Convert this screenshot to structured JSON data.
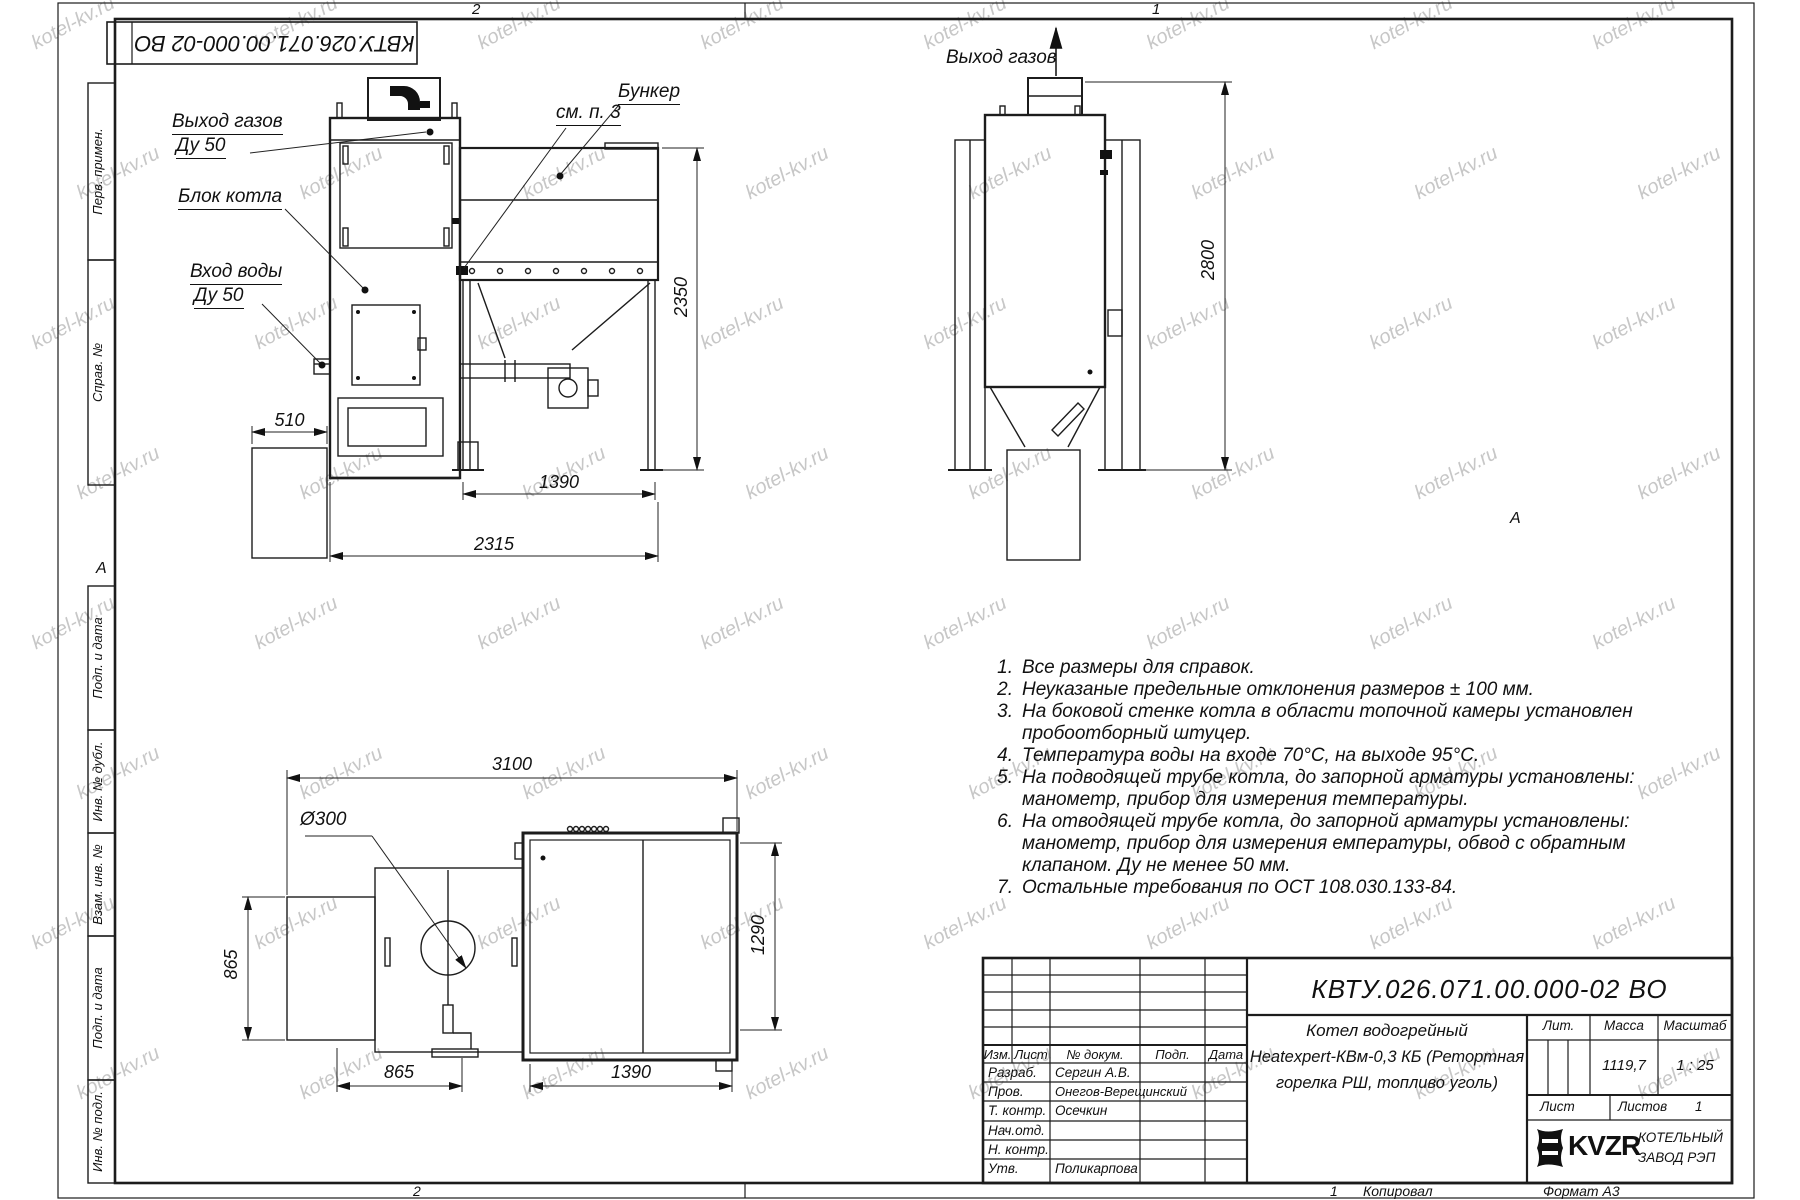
{
  "watermark": {
    "text": "kotel-kv.ru"
  },
  "frame": {
    "doc_number_top": "КВТУ.026.071.00.000-02 ВО",
    "zone_top_left": "2",
    "zone_top_right": "1",
    "zone_bottom_left": "2",
    "zone_bottom_right": "1",
    "copied_label": "Копировал",
    "format_label": "Формат А3",
    "zone_marker_left": "А",
    "zone_marker_right": "А",
    "stamps": [
      {
        "label": "Перв. примен."
      },
      {
        "label": "Справ. №"
      },
      {
        "label": "Подп. и дата"
      },
      {
        "label": "Инв. № дубл."
      },
      {
        "label": "Взам. инв. №"
      },
      {
        "label": "Подп. и дата"
      },
      {
        "label": "Инв. № подл."
      }
    ]
  },
  "views": {
    "front": {
      "labels": {
        "gas_out": "Выход газов",
        "gas_out_dn": "Ду 50",
        "boiler_block": "Блок котла",
        "water_in": "Вход воды",
        "water_in_dn": "Ду 50",
        "see_note": "см. п. 3",
        "bunker": "Бункер"
      },
      "dims": {
        "d510": "510",
        "d1390": "1390",
        "d2315": "2315",
        "d2350": "2350"
      }
    },
    "side": {
      "labels": {
        "gas_out": "Выход газов"
      },
      "dims": {
        "d2800": "2800"
      }
    },
    "plan": {
      "dims": {
        "d3100": "3100",
        "d300": "Ø300",
        "d865_left": "865",
        "d865_bottom": "865",
        "d1390": "1390",
        "d1290": "1290"
      }
    }
  },
  "notes": {
    "lines": [
      {
        "n": "1.",
        "t": "Все размеры для справок."
      },
      {
        "n": "2.",
        "t": "Неуказаные предельные отклонения размеров ± 100 мм."
      },
      {
        "n": "3.",
        "t": "На боковой стенке котла в области топочной камеры установлен"
      },
      {
        "n": "",
        "t": "пробоотборный штуцер."
      },
      {
        "n": "4.",
        "t": "Температура воды на входе 70°С, на выходе 95°С."
      },
      {
        "n": "5.",
        "t": "На подводящей трубе котла, до запорной арматуры установлены:"
      },
      {
        "n": "",
        "t": "манометр, прибор для измерения температуры."
      },
      {
        "n": "6.",
        "t": "На отводящей трубе котла, до запорной арматуры установлены:"
      },
      {
        "n": "",
        "t": "манометр, прибор для измерения емпературы, обвод с обратным"
      },
      {
        "n": "",
        "t": "клапаном. Ду не менее 50 мм."
      },
      {
        "n": "7.",
        "t": "Остальные требования по ОСТ 108.030.133-84."
      }
    ]
  },
  "title_block": {
    "doc_number": "КВТУ.026.071.00.000-02 ВО",
    "product_name_line1": "Котел водогрейный",
    "product_name_line2": "Heatexpert-КВм-0,3 КБ (Ретортная",
    "product_name_line3": "горелка РШ, топливо уголь)",
    "header": {
      "izm": "Изм.",
      "list": "Лист",
      "doc": "№ докум.",
      "podp": "Подп.",
      "data": "Дата"
    },
    "rows": [
      {
        "role": "Разраб.",
        "name": "Сергин А.В."
      },
      {
        "role": "Пров.",
        "name": "Онегов-Верещинский"
      },
      {
        "role": "Т. контр.",
        "name": "Осечкин"
      },
      {
        "role": "Нач.отд.",
        "name": ""
      },
      {
        "role": "Н. контр.",
        "name": ""
      },
      {
        "role": "Утв.",
        "name": "Поликарпова"
      }
    ],
    "lit_label": "Лит.",
    "mass_label": "Масса",
    "scale_label": "Масштаб",
    "mass_value": "1119,7",
    "scale_value": "1 : 25",
    "sheet_label": "Лист",
    "sheets_label": "Листов",
    "sheets_value": "1",
    "company_logo_text": "KVZR",
    "company_name_line1": "КОТЕЛЬНЫЙ",
    "company_name_line2": "ЗАВОД РЭП"
  }
}
